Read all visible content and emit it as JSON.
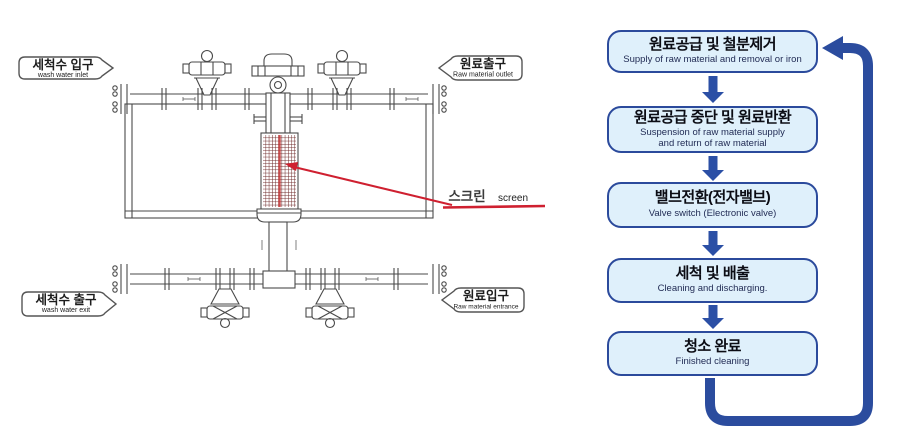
{
  "diagram": {
    "callouts": {
      "wash_water_inlet": {
        "ko": "세척수 입구",
        "en": "wash water inlet"
      },
      "raw_material_outlet": {
        "ko": "원료출구",
        "en": "Raw material outlet"
      },
      "wash_water_exit": {
        "ko": "세척수 출구",
        "en": "wash water exit"
      },
      "raw_material_entrance": {
        "ko": "원료입구",
        "en": "Raw material entrance"
      }
    },
    "screen_label": {
      "ko": "스크린",
      "en": "screen"
    },
    "colors": {
      "line": "#4a4a4a",
      "screen_mesh": "#6e2a2a",
      "red_accent": "#cf2030"
    }
  },
  "flowchart": {
    "steps": [
      {
        "ko": "원료공급 및 철분제거",
        "en": "Supply of raw material and removal or iron"
      },
      {
        "ko": "원료공급 중단 및 원료반환",
        "en": "Suspension of raw material supply\nand return of raw material"
      },
      {
        "ko": "밸브전환(전자밸브)",
        "en": "Valve switch (Electronic valve)"
      },
      {
        "ko": "세척 및 배출",
        "en": "Cleaning and discharging."
      },
      {
        "ko": "청소 완료",
        "en": "Finished cleaning"
      }
    ],
    "colors": {
      "box_fill": "#dff0fb",
      "box_border": "#2b4a9c",
      "arrow": "#2b4fa5",
      "loop": "#2b4c9e"
    }
  }
}
